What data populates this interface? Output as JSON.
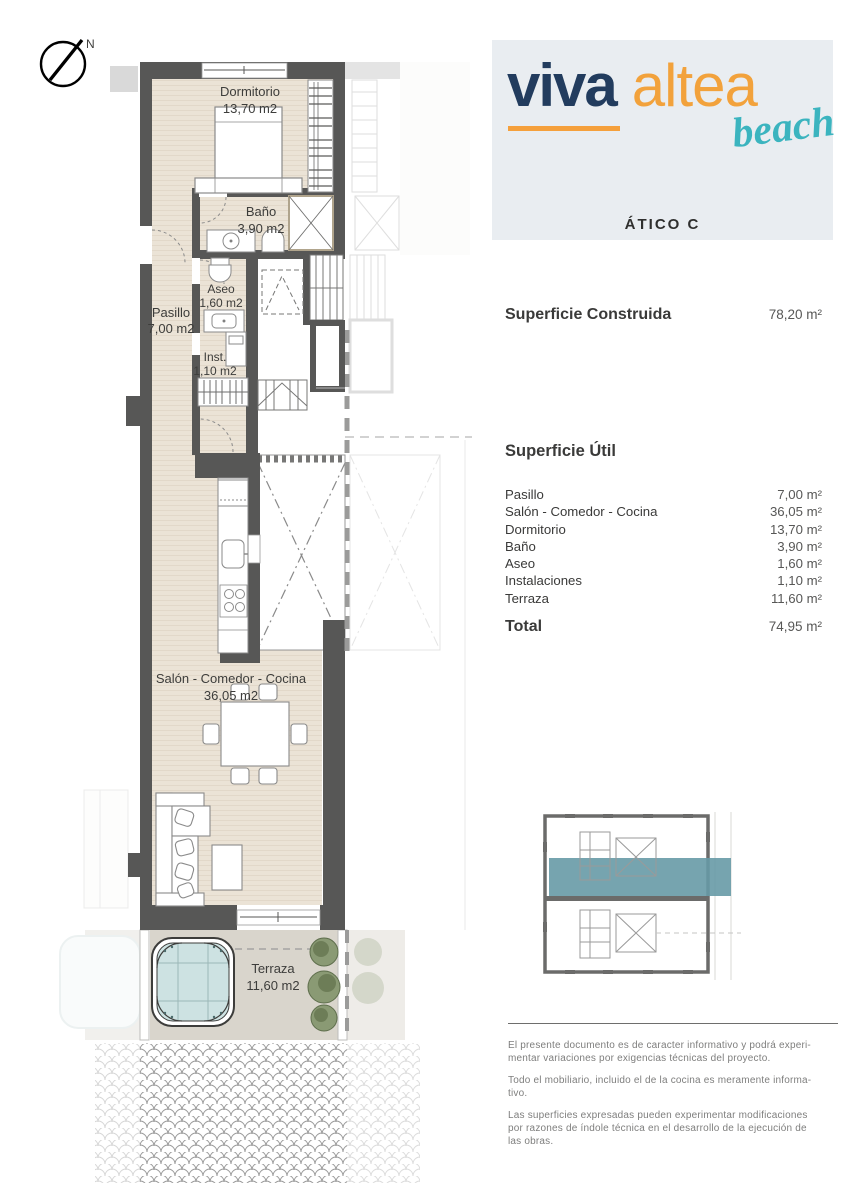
{
  "logo": {
    "viva": "viva",
    "altea": "altea",
    "beach": "beach",
    "unit_label": "ÁTICO C"
  },
  "north_label": "N",
  "areas": {
    "construida_label": "Superficie Construida",
    "construida_value": "78,20 m²",
    "util_label": "Superficie Útil",
    "rows": [
      {
        "label": "Pasillo",
        "value": "7,00 m²"
      },
      {
        "label": "Salón - Comedor - Cocina",
        "value": "36,05 m²"
      },
      {
        "label": "Dormitorio",
        "value": "13,70 m²"
      },
      {
        "label": "Baño",
        "value": "3,90 m²"
      },
      {
        "label": "Aseo",
        "value": "1,60 m²"
      },
      {
        "label": "Instalaciones",
        "value": "1,10 m²"
      },
      {
        "label": "Terraza",
        "value": "11,60 m²"
      }
    ],
    "total_label": "Total",
    "total_value": "74,95 m²"
  },
  "plan": {
    "rooms": {
      "dormitorio": {
        "name": "Dormitorio",
        "area": "13,70 m2"
      },
      "bano": {
        "name": "Baño",
        "area": "3,90 m2"
      },
      "aseo": {
        "name": "Aseo",
        "area": "1,60 m2"
      },
      "pasillo": {
        "name": "Pasillo",
        "area": "7,00 m2"
      },
      "inst": {
        "name": "Inst.",
        "area": "1,10 m2"
      },
      "salon": {
        "name": "Salón - Comedor - Cocina",
        "area": "36,05 m2"
      },
      "terraza": {
        "name": "Terraza",
        "area": "11,60 m2"
      }
    }
  },
  "disclaimer": {
    "p1": "El presente documento es de caracter informativo y podrá experi-\nmentar variaciones por exigencias técnicas del proyecto.",
    "p2": "Todo el mobiliario, incluido el de la cocina es meramente informa-\ntivo.",
    "p3": "Las superficies expresadas pueden experimentar modificaciones\npor razones de índole técnica en el desarrollo de la ejecución de\nlas obras."
  },
  "colors": {
    "brand_navy": "#223C5E",
    "brand_orange": "#F2A23C",
    "brand_teal": "#3BB4BF",
    "keyplan_highlight": "#679AA6",
    "wall_gray": "#575756",
    "floor_beige": "#EBE3D6",
    "terrace_gray": "#D9D5CC",
    "water_teal": "#CDE2E2"
  }
}
